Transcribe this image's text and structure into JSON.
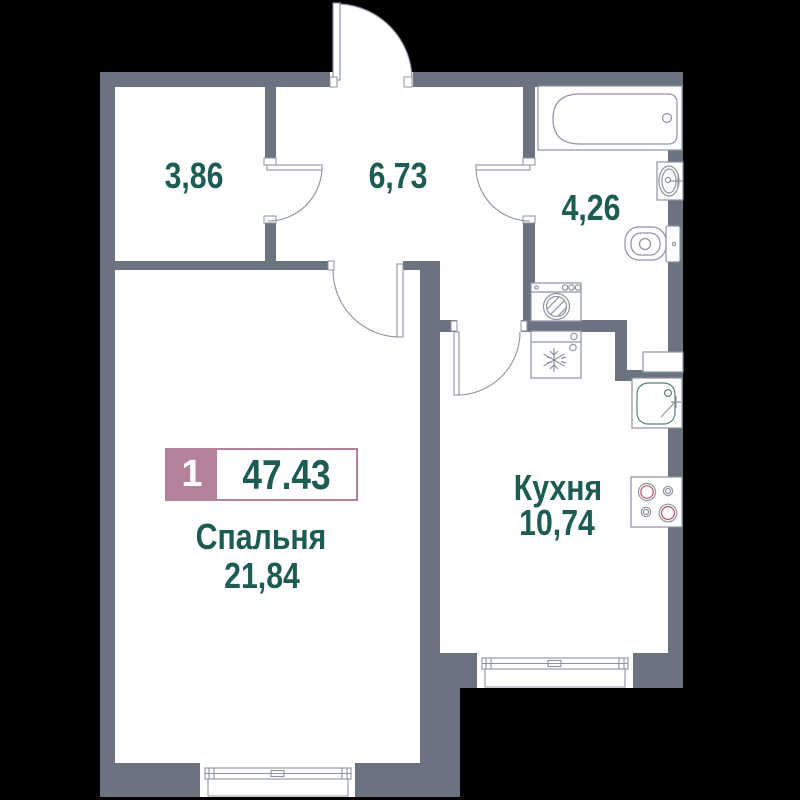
{
  "colors": {
    "background": "#000000",
    "floor": "#ffffff",
    "wall": "#6b7280",
    "fixture_outline": "#8d93a1",
    "sink_outline": "#5f8079",
    "label_text": "#1d5c52",
    "badge_pink": "#b5809a",
    "badge_count_text": "#ffffff",
    "burner_red": "#b55160"
  },
  "badge": {
    "room_count": "1",
    "total_area": "47.43"
  },
  "rooms": {
    "storage": {
      "area": "3,86"
    },
    "hallway": {
      "area": "6,73"
    },
    "bathroom": {
      "area": "4,26"
    },
    "kitchen": {
      "name": "Кухня",
      "area": "10,74"
    },
    "bedroom": {
      "name": "Спальня",
      "area": "21,84"
    }
  },
  "fixtures": {
    "bathroom": [
      "bathtub",
      "washbasin",
      "toilet",
      "washing-machine"
    ],
    "kitchen": [
      "refrigerator",
      "kitchen-sink",
      "cooktop",
      "cabinet"
    ],
    "windows": [
      "bedroom-window",
      "kitchen-window"
    ],
    "doors": [
      "entrance-door",
      "storage-door",
      "bathroom-door",
      "bedroom-door",
      "kitchen-door"
    ]
  }
}
